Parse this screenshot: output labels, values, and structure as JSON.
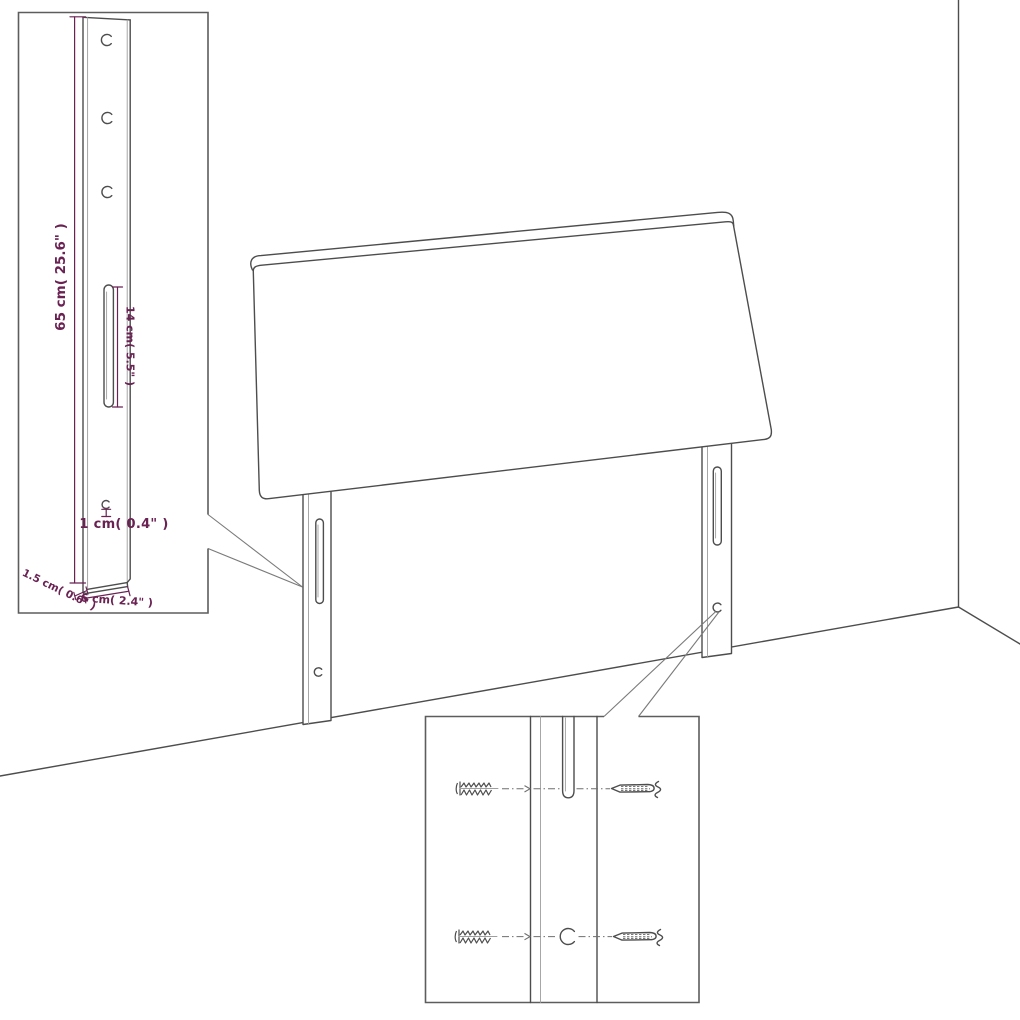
{
  "canvas": {
    "width": 1020,
    "height": 1020,
    "background": "#ffffff"
  },
  "palette": {
    "line": "#4d4d4d",
    "line_light": "#9e9e9e",
    "callout_line": "#7a7a7a",
    "dimension": "#6a2253"
  },
  "diagram": {
    "type": "furniture-assembly-dimension-diagram",
    "subject": "Headboard panel with two mounting legs standing in a room corner; zoom inset of a leg with dimensions and zoom inset of wall-fixing hardware"
  },
  "dimensions": {
    "leg_height": "65 cm( 25.6\" )",
    "slot_length": "14 cm( 5.5\" )",
    "hole_size": "1 cm( 0.4\" )",
    "leg_thickness": "1.5 cm( 0.6\" )",
    "leg_width": "6 cm( 2.4\" )"
  },
  "icons": {
    "wall_anchor": "threaded-wall-plug-sketch",
    "screw": "tapered-screw-sketch"
  },
  "hardware": {
    "wall_anchors": 2,
    "screws": 2
  }
}
